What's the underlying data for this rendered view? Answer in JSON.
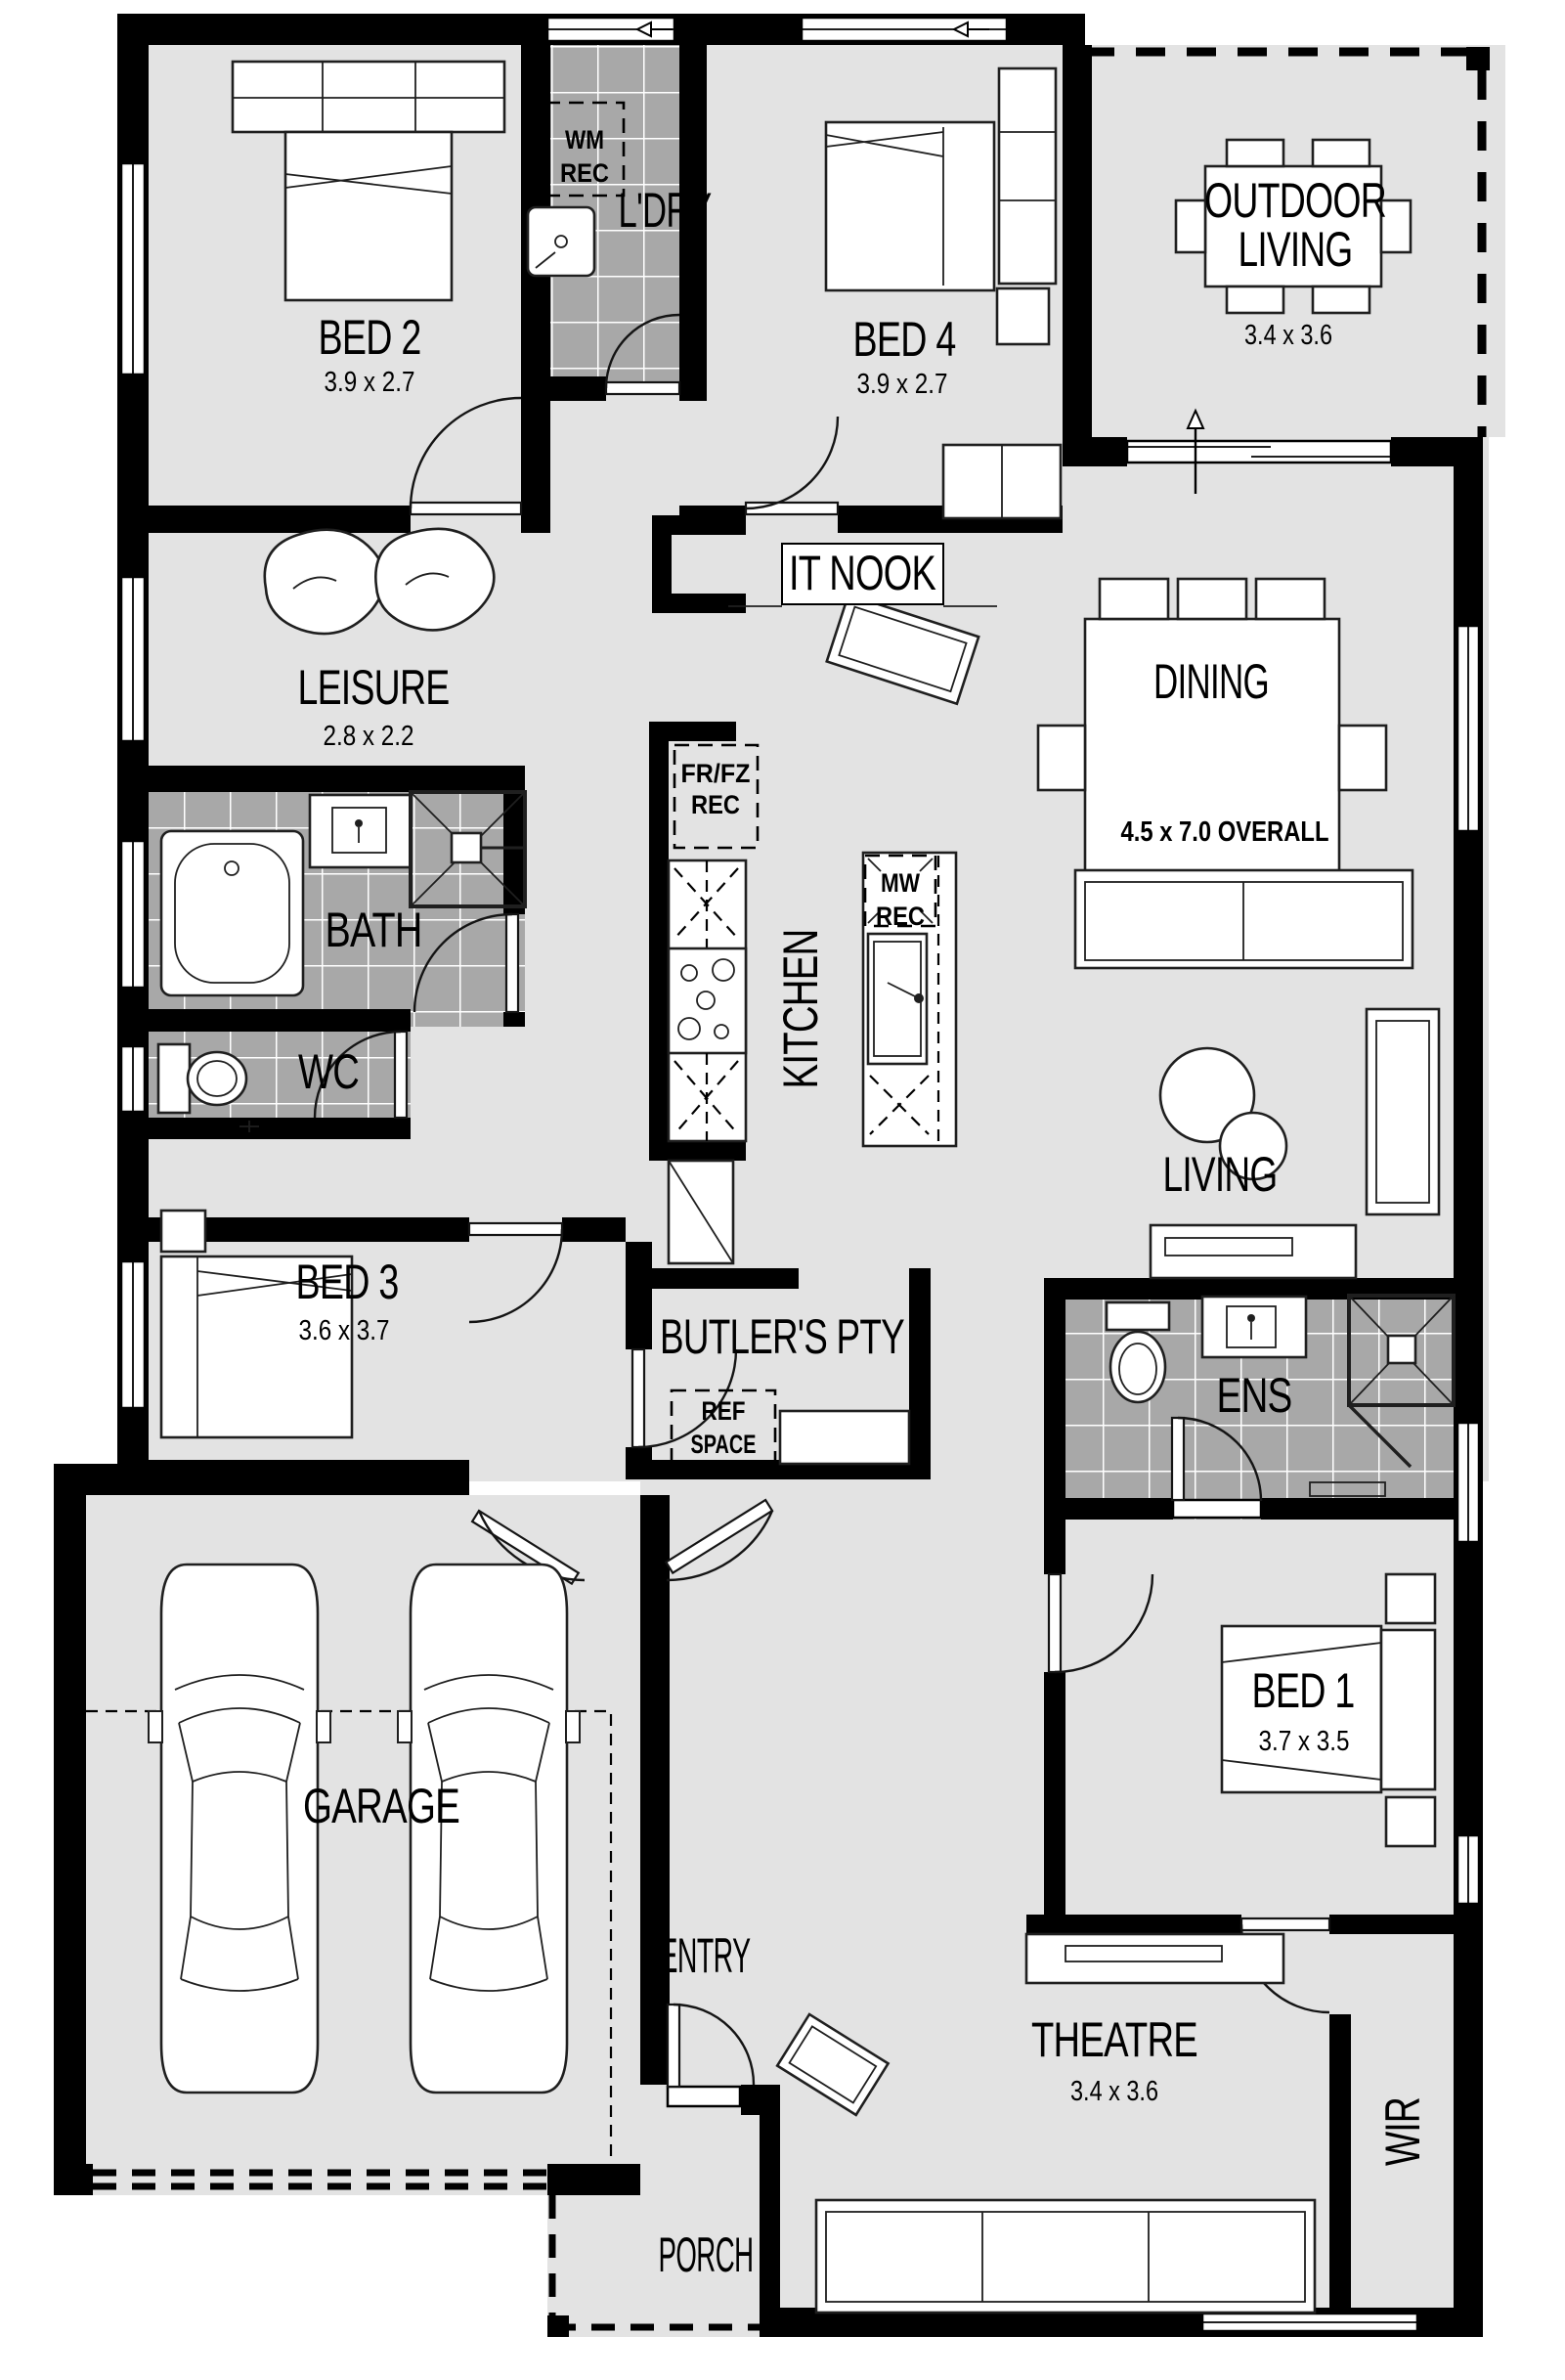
{
  "plan_title": "Floor Plan",
  "colors": {
    "floor": "#e3e3e3",
    "tile": "#a8a8a8",
    "wall": "#000000",
    "paper": "#ffffff"
  },
  "rooms": {
    "bed2": {
      "name": "BED 2",
      "dims": "3.9 x 2.7"
    },
    "ldry": {
      "name": "L'DRY"
    },
    "bed4": {
      "name": "BED 4",
      "dims": "3.9 x 2.7"
    },
    "outdoor": {
      "line1": "OUTDOOR",
      "line2": "LIVING",
      "dims": "3.4 x 3.6"
    },
    "itnook": {
      "name": "IT NOOK"
    },
    "leisure": {
      "name": "LEISURE",
      "dims": "2.8 x 2.2"
    },
    "dining": {
      "name": "DINING",
      "overall": "4.5 x 7.0 OVERALL"
    },
    "kitchen": {
      "name": "KITCHEN"
    },
    "bath": {
      "name": "BATH"
    },
    "wc": {
      "name": "WC"
    },
    "living": {
      "name": "LIVING"
    },
    "bed3": {
      "name": "BED 3",
      "dims": "3.6 x 3.7"
    },
    "butlers": {
      "name": "BUTLER'S PTY"
    },
    "ens": {
      "name": "ENS"
    },
    "bed1": {
      "name": "BED 1",
      "dims": "3.7 x 3.5"
    },
    "garage": {
      "name": "GARAGE"
    },
    "entry": {
      "name": "ENTRY"
    },
    "theatre": {
      "name": "THEATRE",
      "dims": "3.4 x 3.6"
    },
    "wir": {
      "name": "WIR"
    },
    "porch": {
      "name": "PORCH"
    }
  },
  "recesses": {
    "wm": {
      "line1": "WM",
      "line2": "REC"
    },
    "frfz": {
      "line1": "FR/FZ",
      "line2": "REC"
    },
    "mw": {
      "line1": "MW",
      "line2": "REC"
    },
    "ref": {
      "line1": "REF",
      "line2": "SPACE"
    }
  }
}
